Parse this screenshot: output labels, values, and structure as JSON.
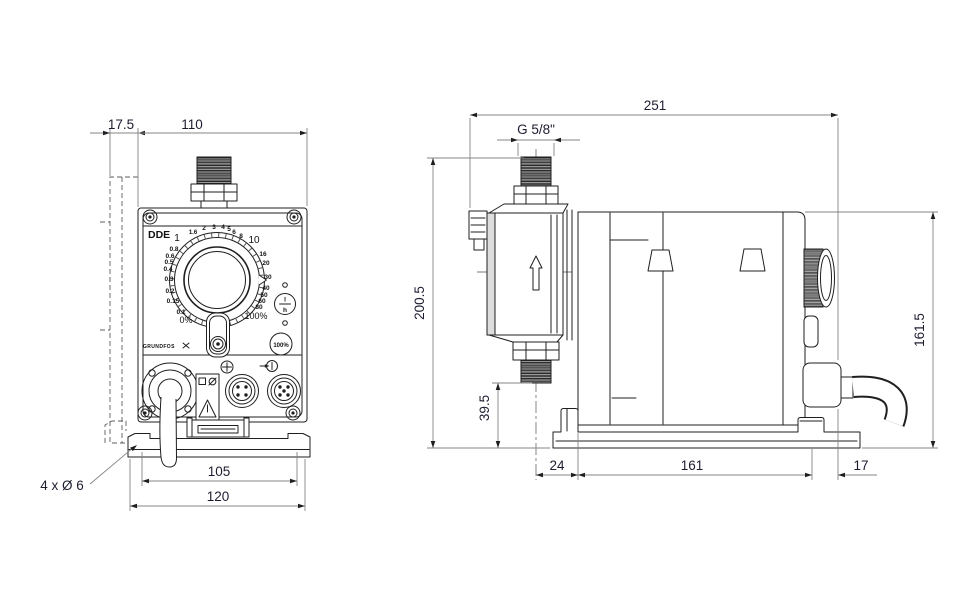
{
  "front_view": {
    "model_label": "DDE",
    "brand_label": "GRUNDFOS",
    "dial": {
      "scale_upper": [
        "1",
        "1.6",
        "2",
        "3",
        "4",
        "5",
        "6",
        "8",
        "10"
      ],
      "scale_right": [
        "16",
        "20",
        "30",
        "40",
        "50",
        "60",
        "80"
      ],
      "scale_left": [
        "0.8",
        "0.6",
        "0.5",
        "0.4",
        "0.3",
        "0.2",
        "0.15",
        "0.1"
      ],
      "min_label": "0%",
      "max_label": "100%"
    },
    "buttons": {
      "unit_top": "l",
      "unit_bottom": "h",
      "prime_label": "100%"
    }
  },
  "dimensions": {
    "plate_depth": "17.5",
    "front_width": "110",
    "base_inner_width": "105",
    "base_width": "120",
    "mounting_holes": "4 x Ø 6",
    "total_length": "251",
    "connection_thread": "G 5/8\"",
    "total_height": "200.5",
    "housing_height": "161.5",
    "outlet_height": "39.5",
    "head_offset": "24",
    "housing_length": "161",
    "rear_offset": "17"
  },
  "colors": {
    "line": "#1f1f1f",
    "dimension": "#858585",
    "text": "#1d1d30"
  }
}
